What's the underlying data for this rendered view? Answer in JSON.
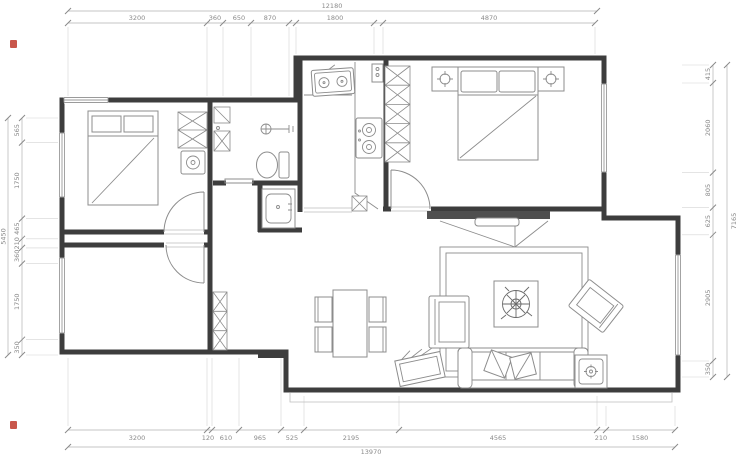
{
  "dimensions": {
    "top": {
      "total": "12180",
      "segments": [
        "3200",
        "360",
        "650",
        "870",
        "1800",
        "4870"
      ]
    },
    "bottom": {
      "total": "13970",
      "segments": [
        "3200",
        "120",
        "610",
        "965",
        "525",
        "2195",
        "4565",
        "210",
        "1580"
      ]
    },
    "left": {
      "total": "5450",
      "segments": [
        "565",
        "1750",
        "465",
        "210",
        "360",
        "1750",
        "350"
      ]
    },
    "right": {
      "total": "7165",
      "segments": [
        "415",
        "2060",
        "805",
        "625",
        "2905",
        "350"
      ]
    }
  },
  "colors": {
    "wall": "#3d3d3d",
    "furniture_line": "#8c8c8c",
    "dimension_line": "#b3b3b3",
    "dimension_text": "#8a8a8a",
    "media_wall": "#4f4f4f",
    "red_mark": "#c0392b",
    "background": "#ffffff"
  }
}
